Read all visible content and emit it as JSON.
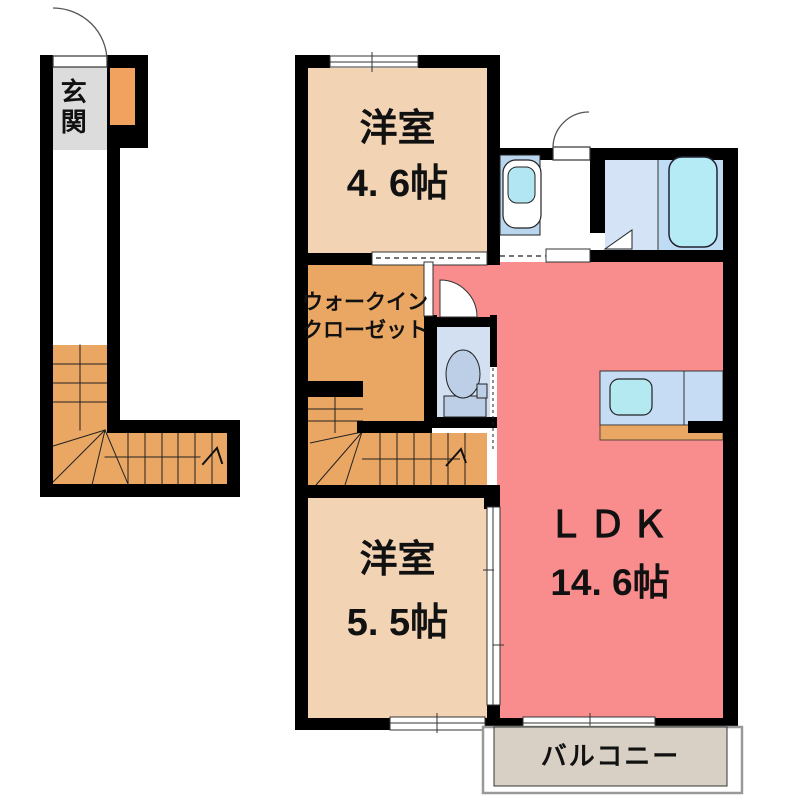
{
  "plan": {
    "rooms": {
      "entrance": {
        "label": "玄関"
      },
      "bedroom1": {
        "name": "洋室",
        "size": "4. 6帖"
      },
      "walk_in_closet": {
        "line1": "ウォークイン",
        "line2": "クローゼット"
      },
      "bedroom2": {
        "name": "洋室",
        "size": "5. 5帖"
      },
      "ldk": {
        "name": "ＬＤＫ",
        "size": "14. 6帖"
      },
      "balcony": {
        "label": "バルコニー"
      }
    },
    "icons": [
      "bathtub-icon",
      "washbasin-icon",
      "toilet-icon",
      "kitchen-sink-icon",
      "door-swing-icon",
      "sliding-door-icon",
      "folding-door-icon",
      "stairs-up-arrow-icon"
    ],
    "colors": {
      "wall": "#000000",
      "bedroom_floor": "#f2d3b4",
      "closet_and_stairs": "#eaa763",
      "entrance_floor": "#dcdcdc",
      "ldk_floor": "#f98c8c",
      "bathroom_floor": "#d4e4f6",
      "tub_water": "#b4ebf5",
      "toilet_floor": "#d2e0f2",
      "fixture_blue": "#bccfe6",
      "vanity_blue": "#b9d6ee",
      "kitchen_counter": "#c6dcf4",
      "sink_water": "#b5e9f2",
      "balcony_floor": "#d8d0c5"
    }
  }
}
